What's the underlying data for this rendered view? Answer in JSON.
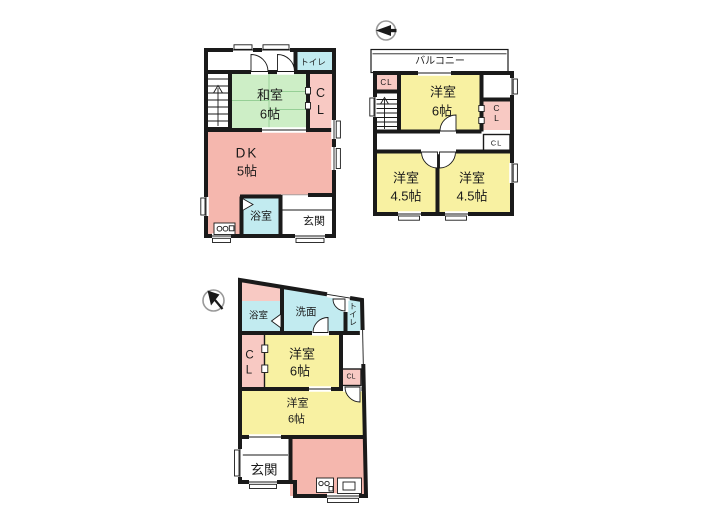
{
  "colors": {
    "wall": "#1a1a1a",
    "text": "#1a1a1a",
    "tatami_green": "#cdeec6",
    "western_yellow": "#f8f1a2",
    "kitchen_pink": "#f5b7ae",
    "closet_pink": "#f8c9c3",
    "wet_area_cyan": "#c2ebf0",
    "compass_gray": "#999999"
  },
  "icons": {
    "plan2_compass": "north-arrow",
    "plan3_compass": "north-arrow"
  },
  "plan1": {
    "labels": {
      "toilet": "トイレ",
      "washitsu": "和室",
      "washitsu_size": "6帖",
      "closet_c": "C",
      "closet_l": "L",
      "dk": "DK",
      "dk_size": "5帖",
      "bath": "浴室",
      "entrance": "玄関"
    }
  },
  "plan2": {
    "labels": {
      "balcony": "バルコニー",
      "closet_top_left": "CL",
      "main_room": "洋室",
      "main_room_size": "6帖",
      "closet_right_c": "C",
      "closet_right_l": "L",
      "closet_hall": "CL",
      "room_left": "洋室",
      "room_left_size": "4.5帖",
      "room_right": "洋室",
      "room_right_size": "4.5帖"
    }
  },
  "plan3": {
    "labels": {
      "bath": "浴室",
      "washroom": "洗面",
      "toilet": "トイレ",
      "closet_c": "C",
      "closet_l": "L",
      "room1": "洋室",
      "room1_size": "6帖",
      "closet_small": "CL",
      "room2": "洋室",
      "room2_size": "6帖",
      "entrance": "玄関"
    }
  }
}
